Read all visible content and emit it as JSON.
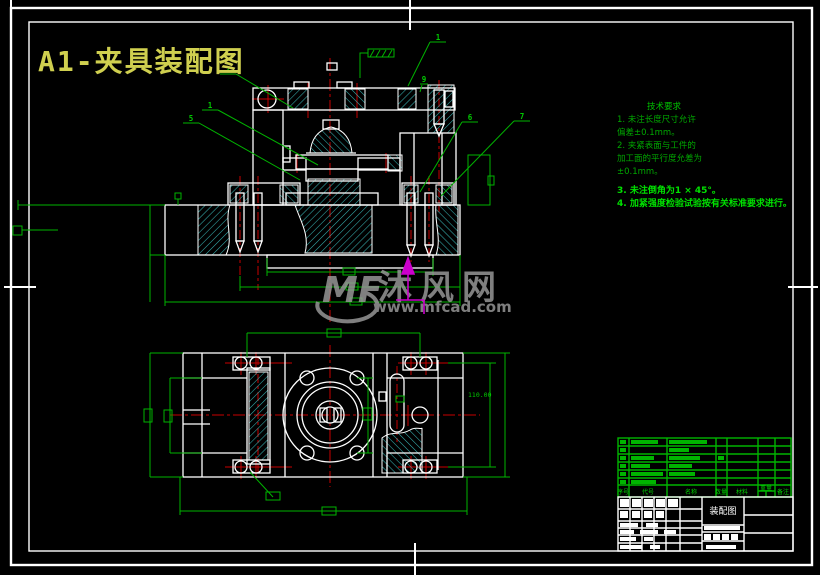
{
  "title": {
    "text": "A1-夹具装配图",
    "color": "#cfcf4f"
  },
  "watermark": {
    "logo": "MF",
    "site_name": "沐风网",
    "site_url": "www.mfcad.com"
  },
  "tech_notes": {
    "heading": "技术要求",
    "lines": [
      "1. 未注长度尺寸允许",
      "偏差±0.1mm。",
      "2. 夹紧表面与工件的",
      "加工面的平行度允差为",
      "±0.1mm。"
    ],
    "bold": [
      "3. 未注倒角为1 × 45°。",
      "4. 加紧强度检验试验按有关标准要求进行。"
    ]
  },
  "callouts": {
    "c2": "2",
    "c1a": "1",
    "c5": "5",
    "c1b": "1",
    "c9": "9",
    "c6": "6",
    "c7": "7"
  },
  "dims": {
    "plan_right": "110.00"
  },
  "bom": {
    "headers": [
      "序号",
      "代号",
      "名称",
      "数量",
      "材料",
      "重量",
      "备注"
    ]
  },
  "title_block": {
    "drawing_name": "装配图"
  },
  "colors": {
    "line": "#ffffff",
    "dim": "#00b400",
    "center": "#c80000",
    "hatch": "#37b0b0",
    "accent": "#cc00cc",
    "watermark": "#9b9b9b"
  }
}
